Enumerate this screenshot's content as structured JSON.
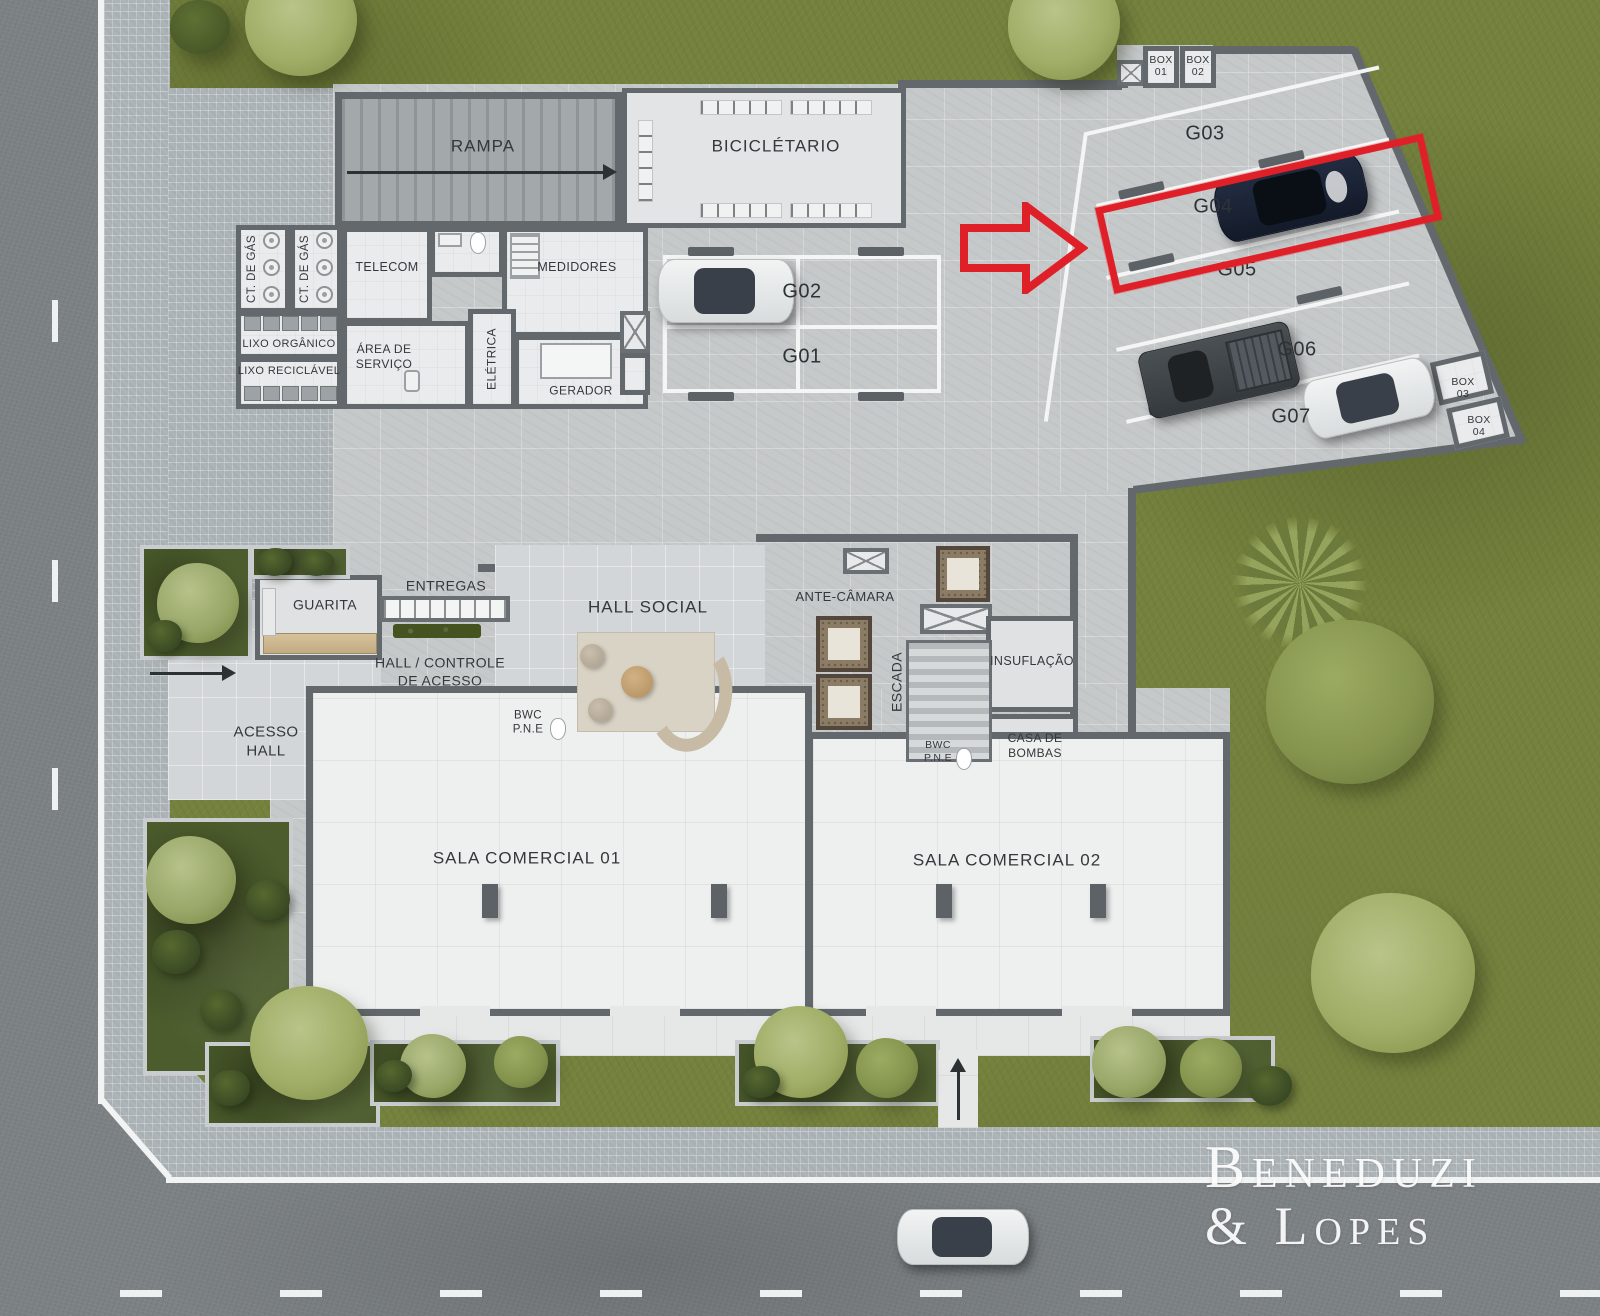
{
  "palette": {
    "accent_red": "#e02028",
    "grass_green": "#75823d",
    "asphalt_gray": "#7c8184",
    "paver_gray": "#adb4b8",
    "concrete_gray": "#c6c9ca",
    "wall_gray": "#63686c",
    "floor_white": "#eef0f0",
    "line_white": "#f4f5f5",
    "planter_green": "#4c5c2c"
  },
  "areas": {
    "rampa": "RAMPA",
    "bicicletario": "BICICLÉTARIO",
    "ct_de_gas_1": "CT. DE GÁS",
    "ct_de_gas_2": "CT. DE GÁS",
    "telecom": "TELECOM",
    "medidores": "MEDIDORES",
    "lixo_organico": "LIXO ORGÂNICO",
    "lixo_reciclavel": "LIXO RECICLÁVEL",
    "area_servico_l1": "ÁREA DE",
    "area_servico_l2": "SERVIÇO",
    "eletrica": "ELÉTRICA",
    "gerador": "GERADOR",
    "guarita": "GUARITA",
    "entregas": "ENTREGAS",
    "hall_social": "HALL SOCIAL",
    "hall_controle_l1": "HALL / CONTROLE",
    "hall_controle_l2": "DE ACESSO",
    "acesso_l1": "ACESSO",
    "acesso_l2": "HALL",
    "bwc_1_l1": "BWC",
    "bwc_1_l2": "P.N.E",
    "bwc_2_l1": "BWC",
    "bwc_2_l2": "P.N.E",
    "ante_camara": "ANTE-CÂMARA",
    "escada": "ESCADA",
    "insuflacao": "INSUFLAÇÃO",
    "casa_bombas_l1": "CASA DE",
    "casa_bombas_l2": "BOMBAS",
    "sala_comercial_1": "SALA COMERCIAL 01",
    "sala_comercial_2": "SALA COMERCIAL 02"
  },
  "parking": {
    "g01": "G01",
    "g02": "G02",
    "g03": "G03",
    "g04": "G04",
    "g05": "G05",
    "g06": "G06",
    "g07": "G07",
    "highlighted_spot": "G04"
  },
  "boxes": {
    "b1_l1": "BOX",
    "b1_l2": "01",
    "b2_l1": "BOX",
    "b2_l2": "02",
    "b3_l1": "BOX",
    "b3_l2": "03",
    "b4_l1": "BOX",
    "b4_l2": "04"
  },
  "watermark": {
    "line1": "Beneduzi",
    "line2": "& Lopes"
  }
}
